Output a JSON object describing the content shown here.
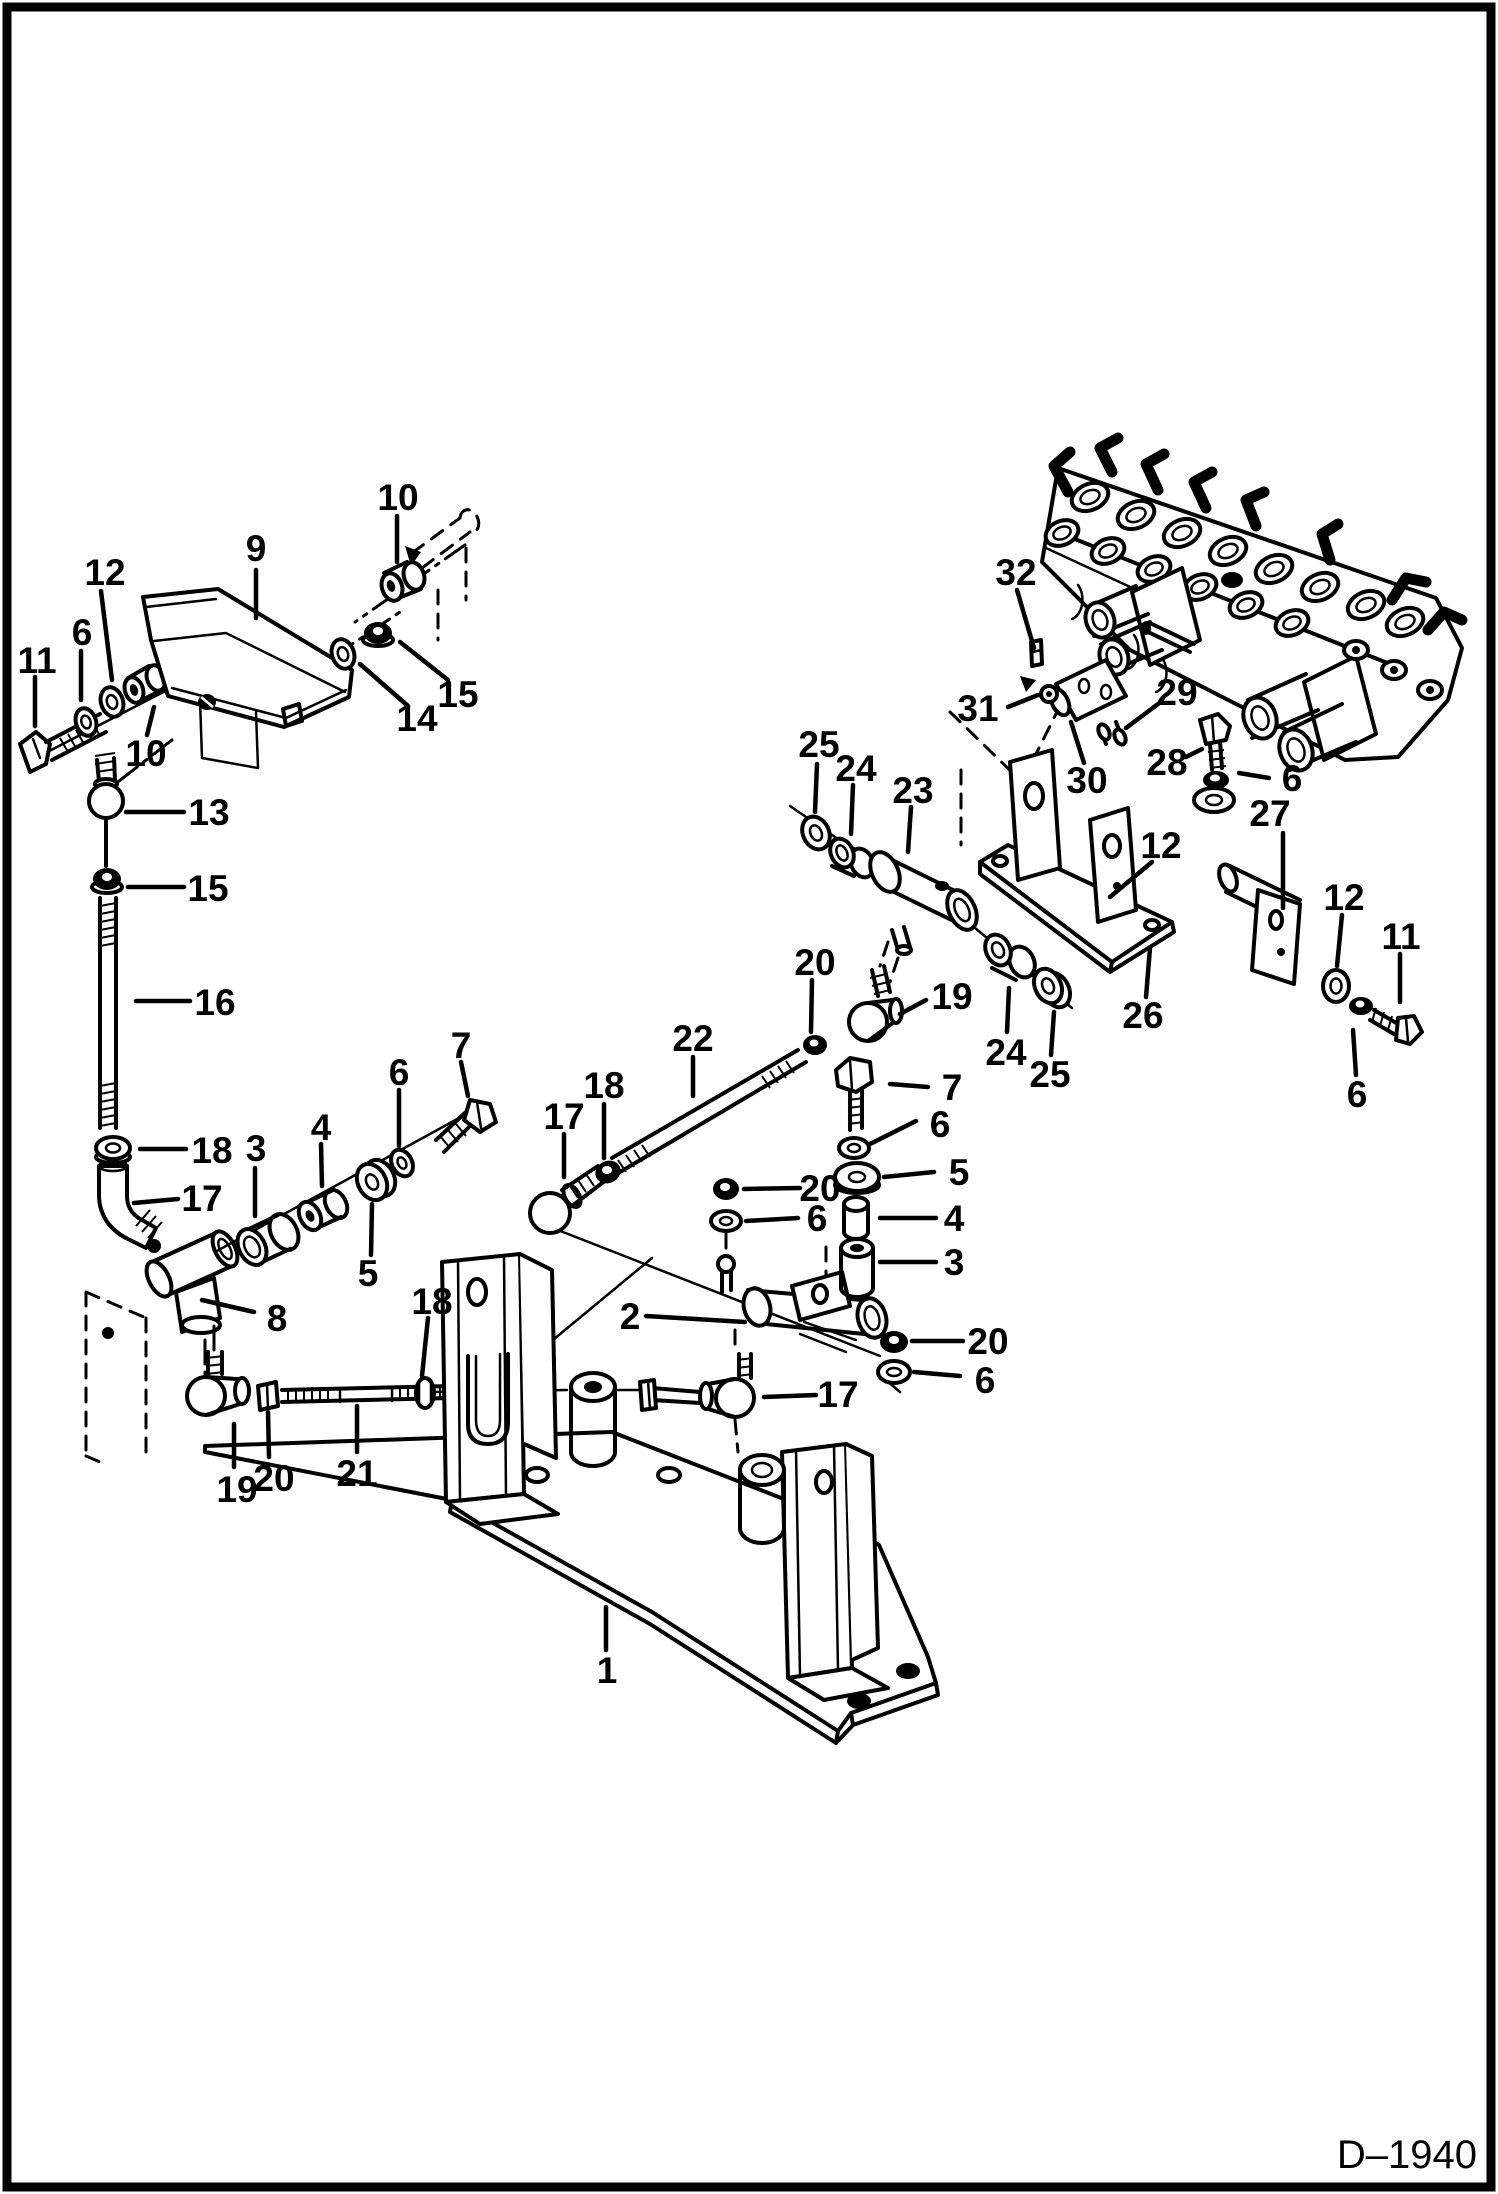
{
  "drawing": {
    "number": "D–1940"
  },
  "colors": {
    "ink": "#000000",
    "paper": "#ffffff"
  },
  "unique_part_numbers": [
    1,
    2,
    3,
    4,
    5,
    6,
    7,
    8,
    9,
    10,
    11,
    12,
    13,
    14,
    15,
    16,
    17,
    18,
    19,
    20,
    21,
    22,
    23,
    24,
    25,
    26,
    27,
    28,
    29,
    30,
    31,
    32
  ],
  "callouts": [
    {
      "text": "10",
      "x": 398,
      "y": 497,
      "leader": [
        397,
        516,
        397,
        562
      ]
    },
    {
      "text": "9",
      "x": 256,
      "y": 548,
      "leader": [
        256,
        570,
        256,
        618
      ]
    },
    {
      "text": "12",
      "x": 105,
      "y": 572,
      "leader": [
        101,
        591,
        112,
        680
      ]
    },
    {
      "text": "6",
      "x": 82,
      "y": 632,
      "leader": [
        81,
        651,
        81,
        700
      ]
    },
    {
      "text": "11",
      "x": 37,
      "y": 660,
      "leader": [
        35,
        677,
        35,
        726
      ]
    },
    {
      "text": "15",
      "x": 458,
      "y": 694,
      "leader": [
        448,
        680,
        400,
        642
      ]
    },
    {
      "text": "14",
      "x": 417,
      "y": 718,
      "leader": [
        408,
        706,
        360,
        664
      ]
    },
    {
      "text": "10",
      "x": 146,
      "y": 753,
      "leader": [
        147,
        735,
        154,
        707
      ]
    },
    {
      "text": "13",
      "x": 209,
      "y": 812,
      "leader": [
        126,
        812,
        184,
        812
      ]
    },
    {
      "text": "15",
      "x": 208,
      "y": 888,
      "leader": [
        128,
        887,
        184,
        887
      ]
    },
    {
      "text": "16",
      "x": 215,
      "y": 1002,
      "leader": [
        136,
        1001,
        190,
        1001
      ]
    },
    {
      "text": "18",
      "x": 212,
      "y": 1150,
      "leader": [
        140,
        1149,
        186,
        1149
      ]
    },
    {
      "text": "17",
      "x": 202,
      "y": 1198,
      "leader": [
        134,
        1203,
        178,
        1199
      ]
    },
    {
      "text": "3",
      "x": 256,
      "y": 1148,
      "leader": [
        255,
        1168,
        255,
        1216
      ]
    },
    {
      "text": "4",
      "x": 321,
      "y": 1127,
      "leader": [
        321,
        1144,
        322,
        1186
      ]
    },
    {
      "text": "6",
      "x": 399,
      "y": 1072,
      "leader": [
        399,
        1090,
        399,
        1146
      ]
    },
    {
      "text": "7",
      "x": 461,
      "y": 1045,
      "leader": [
        461,
        1062,
        468,
        1096
      ]
    },
    {
      "text": "5",
      "x": 368,
      "y": 1273,
      "leader": [
        371,
        1255,
        372,
        1204
      ]
    },
    {
      "text": "8",
      "x": 277,
      "y": 1318,
      "leader": [
        202,
        1300,
        254,
        1312
      ]
    },
    {
      "text": "18",
      "x": 432,
      "y": 1301,
      "leader": [
        428,
        1318,
        422,
        1376
      ]
    },
    {
      "text": "19",
      "x": 237,
      "y": 1489,
      "leader": [
        234,
        1467,
        234,
        1424
      ]
    },
    {
      "text": "20",
      "x": 274,
      "y": 1478,
      "leader": [
        269,
        1457,
        268,
        1412
      ]
    },
    {
      "text": "21",
      "x": 357,
      "y": 1473,
      "leader": [
        357,
        1452,
        357,
        1406
      ]
    },
    {
      "text": "2",
      "x": 630,
      "y": 1316,
      "leader": [
        646,
        1316,
        745,
        1322
      ]
    },
    {
      "text": "17",
      "x": 838,
      "y": 1394,
      "leader": [
        816,
        1395,
        764,
        1397
      ]
    },
    {
      "text": "20",
      "x": 988,
      "y": 1341,
      "leader": [
        963,
        1341,
        912,
        1341
      ]
    },
    {
      "text": "6",
      "x": 985,
      "y": 1380,
      "leader": [
        960,
        1376,
        914,
        1372
      ]
    },
    {
      "text": "1",
      "x": 607,
      "y": 1670,
      "leader": [
        606,
        1650,
        606,
        1607
      ]
    },
    {
      "text": "20",
      "x": 815,
      "y": 962,
      "leader": [
        812,
        980,
        811,
        1032
      ]
    },
    {
      "text": "19",
      "x": 952,
      "y": 996,
      "leader": [
        926,
        1000,
        900,
        1014
      ]
    },
    {
      "text": "22",
      "x": 693,
      "y": 1038,
      "leader": [
        693,
        1057,
        693,
        1096
      ]
    },
    {
      "text": "18",
      "x": 604,
      "y": 1085,
      "leader": [
        604,
        1104,
        604,
        1158
      ]
    },
    {
      "text": "17",
      "x": 564,
      "y": 1116,
      "leader": [
        564,
        1134,
        564,
        1177
      ]
    },
    {
      "text": "7",
      "x": 952,
      "y": 1087,
      "leader": [
        928,
        1087,
        890,
        1084
      ]
    },
    {
      "text": "6",
      "x": 940,
      "y": 1124,
      "leader": [
        916,
        1121,
        870,
        1144
      ]
    },
    {
      "text": "5",
      "x": 959,
      "y": 1172,
      "leader": [
        934,
        1172,
        884,
        1177
      ]
    },
    {
      "text": "20",
      "x": 820,
      "y": 1188,
      "leader": [
        800,
        1188,
        744,
        1189
      ]
    },
    {
      "text": "6",
      "x": 817,
      "y": 1218,
      "leader": [
        798,
        1218,
        746,
        1221
      ]
    },
    {
      "text": "4",
      "x": 954,
      "y": 1218,
      "leader": [
        936,
        1218,
        880,
        1218
      ]
    },
    {
      "text": "3",
      "x": 954,
      "y": 1262,
      "leader": [
        936,
        1262,
        880,
        1262
      ]
    },
    {
      "text": "25",
      "x": 819,
      "y": 744,
      "leader": [
        817,
        764,
        815,
        812
      ]
    },
    {
      "text": "24",
      "x": 856,
      "y": 768,
      "leader": [
        853,
        785,
        851,
        834
      ]
    },
    {
      "text": "23",
      "x": 913,
      "y": 790,
      "leader": [
        911,
        807,
        908,
        852
      ]
    },
    {
      "text": "32",
      "x": 1016,
      "y": 572,
      "leader": [
        1017,
        590,
        1034,
        648
      ]
    },
    {
      "text": "31",
      "x": 978,
      "y": 708,
      "leader": [
        1008,
        707,
        1038,
        695
      ]
    },
    {
      "text": "29",
      "x": 1177,
      "y": 692,
      "leader": [
        1158,
        704,
        1126,
        728
      ]
    },
    {
      "text": "30",
      "x": 1087,
      "y": 780,
      "leader": [
        1084,
        763,
        1071,
        722
      ]
    },
    {
      "text": "28",
      "x": 1167,
      "y": 762,
      "leader": [
        1186,
        757,
        1202,
        749
      ]
    },
    {
      "text": "6",
      "x": 1292,
      "y": 778,
      "leader": [
        1269,
        778,
        1239,
        773
      ]
    },
    {
      "text": "27",
      "x": 1270,
      "y": 813,
      "leader": [
        1283,
        833,
        1283,
        908
      ]
    },
    {
      "text": "12",
      "x": 1161,
      "y": 845,
      "leader": [
        1152,
        862,
        1110,
        897
      ]
    },
    {
      "text": "26",
      "x": 1143,
      "y": 1015,
      "leader": [
        1146,
        997,
        1150,
        948
      ]
    },
    {
      "text": "24",
      "x": 1006,
      "y": 1052,
      "leader": [
        1007,
        1032,
        1009,
        988
      ]
    },
    {
      "text": "25",
      "x": 1050,
      "y": 1074,
      "leader": [
        1051,
        1055,
        1054,
        1012
      ]
    },
    {
      "text": "12",
      "x": 1344,
      "y": 897,
      "leader": [
        1342,
        915,
        1337,
        966
      ]
    },
    {
      "text": "11",
      "x": 1401,
      "y": 936,
      "leader": [
        1400,
        954,
        1400,
        1002
      ]
    },
    {
      "text": "6",
      "x": 1357,
      "y": 1094,
      "leader": [
        1356,
        1075,
        1353,
        1030
      ]
    }
  ]
}
